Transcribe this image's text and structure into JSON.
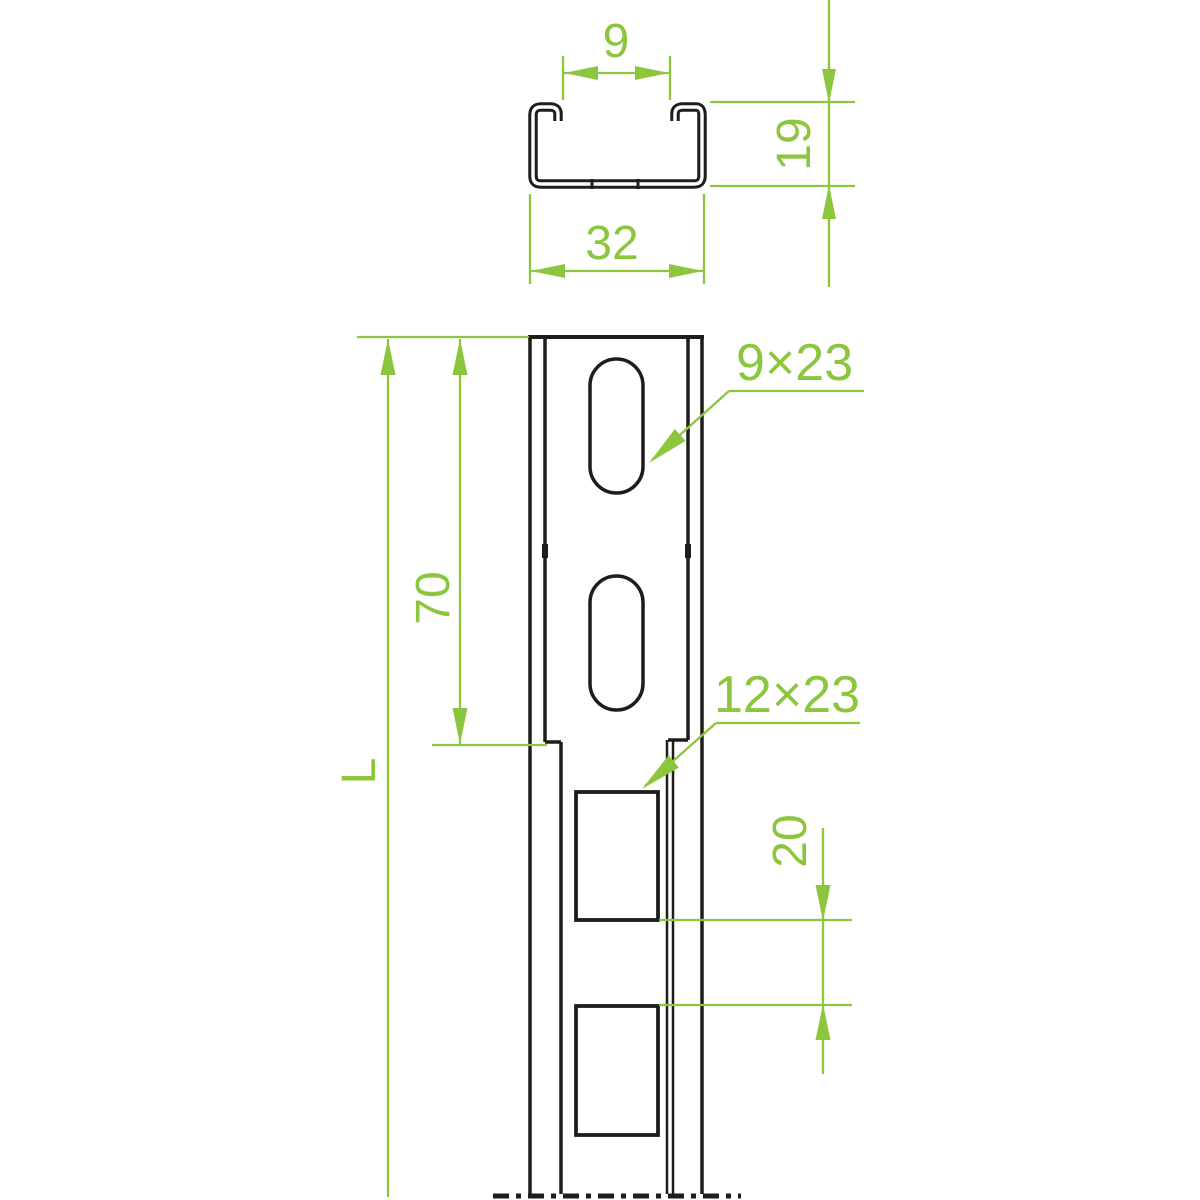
{
  "drawing": {
    "title": "C-profile mounting channel technical drawing",
    "colors": {
      "dimension_green": "#8cc63f",
      "outline_black": "#1d1d1b",
      "background": "#ffffff"
    },
    "cross_section": {
      "opening_width": "9",
      "profile_height": "19",
      "profile_width": "32"
    },
    "front_view": {
      "oval_hole_size": "9×23",
      "rect_hole_size": "12×23",
      "top_section_length": "70",
      "hole_gap": "20",
      "total_length_symbol": "L"
    }
  }
}
